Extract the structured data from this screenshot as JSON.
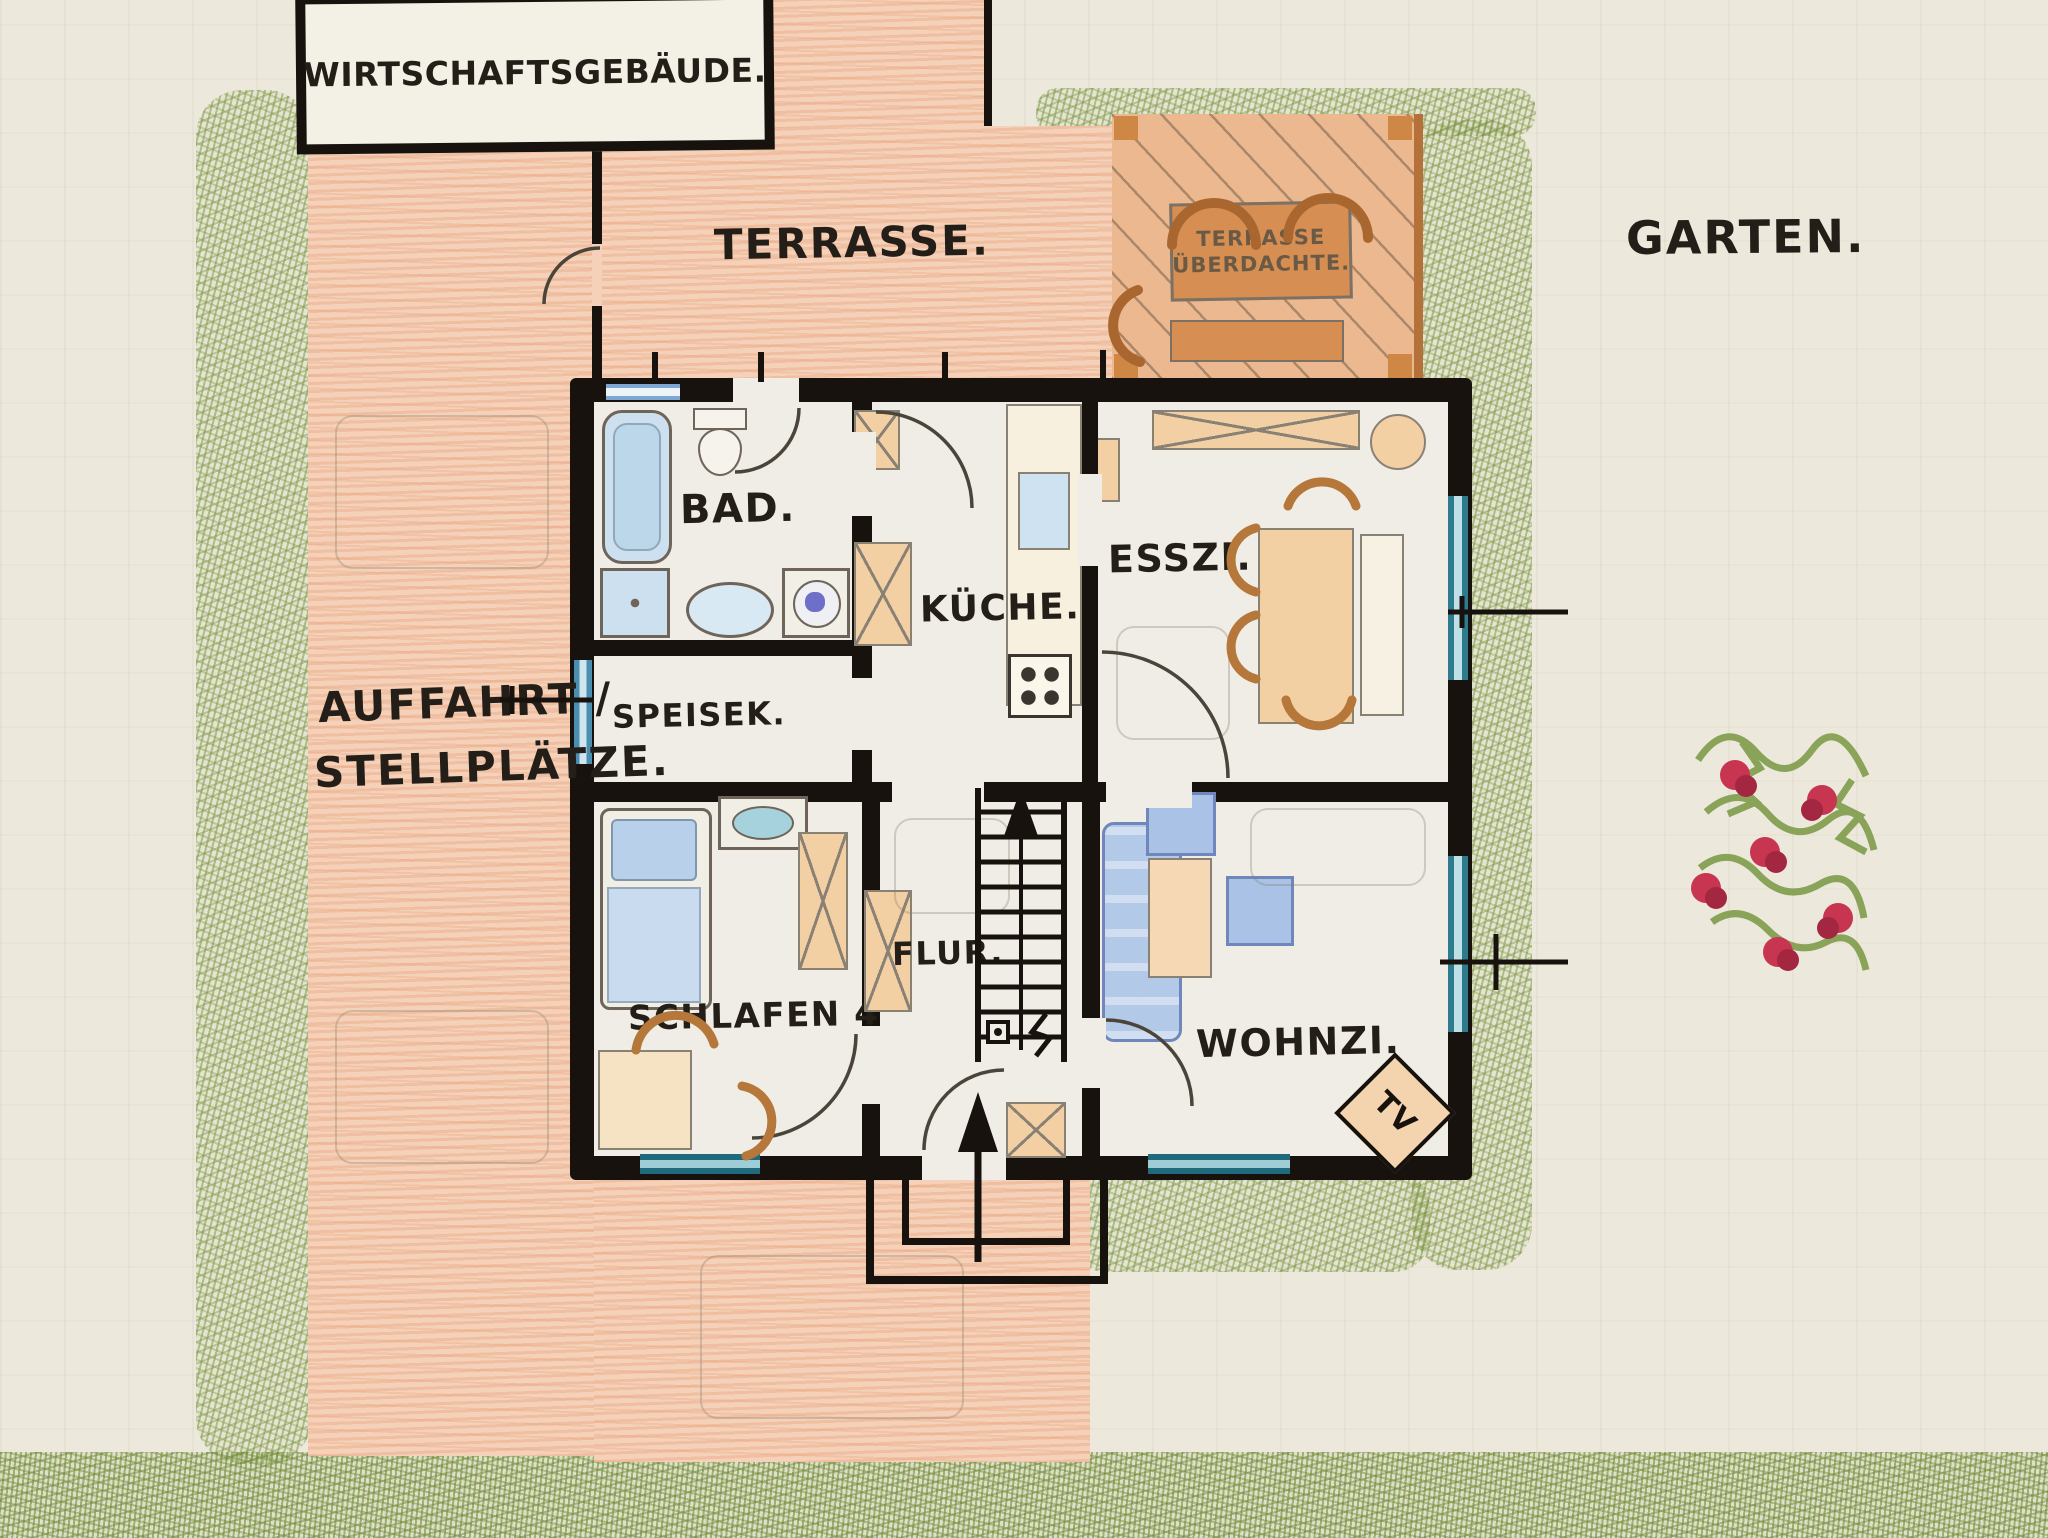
{
  "labels": {
    "outbuilding": "WIRTSCHAFTSGEBÄUDE.",
    "terrace": "TERRASSE.",
    "covered_terrace_line1": "TERRASSE",
    "covered_terrace_line2": "ÜBERDACHTE.",
    "garden": "GARTEN.",
    "driveway_line1": "AUFFAHRT /",
    "driveway_line2": "STELLPLÄTZE."
  },
  "rooms": {
    "bad": "BAD.",
    "kueche": "KÜCHE.",
    "esszi": "ESSZI.",
    "speisek": "SPEISEK.",
    "schlafen": "SCHLAFEN 4.",
    "flur": "FLUR.",
    "wohnzi": "WOHNZI.",
    "tv": "TV"
  },
  "colors": {
    "paper": "#ece9dc",
    "terrace_peach": "#f4d1b8",
    "hedge_green": "#7f9c4b",
    "wall_black": "#17120e",
    "window_blue": "#a3c6e8",
    "window_teal": "#2d7b8c",
    "furniture_peach": "#f3cfa4",
    "furniture_blue": "#aac4e6",
    "flower_red": "#c73550",
    "ink": "#241e18"
  }
}
